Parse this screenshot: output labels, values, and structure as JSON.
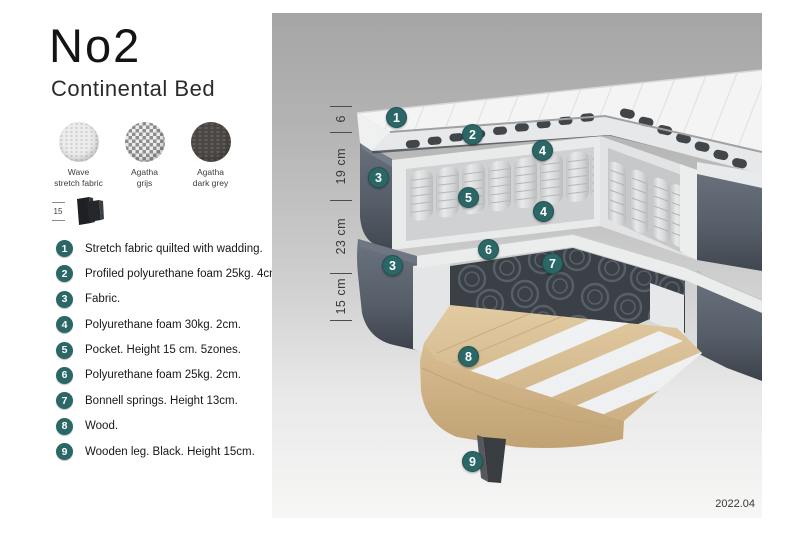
{
  "header": {
    "title": "No2",
    "subtitle": "Continental Bed"
  },
  "swatches": {
    "items": [
      {
        "line1": "Wave",
        "line2": "stretch fabric"
      },
      {
        "line1": "Agatha",
        "line2": "grijs"
      },
      {
        "line1": "Agatha",
        "line2": "dark grey"
      }
    ]
  },
  "leg_spec": {
    "value": "15"
  },
  "legend": {
    "items": [
      {
        "num": "1",
        "text": "Stretch fabric quilted with wadding."
      },
      {
        "num": "2",
        "text": "Profiled polyurethane foam 25kg. 4cm."
      },
      {
        "num": "3",
        "text": "Fabric."
      },
      {
        "num": "4",
        "text": "Polyurethane foam 30kg. 2cm."
      },
      {
        "num": "5",
        "text": "Pocket. Height 15 cm. 5zones."
      },
      {
        "num": "6",
        "text": "Polyurethane foam 25kg. 2cm."
      },
      {
        "num": "7",
        "text": "Bonnell springs. Height 13cm."
      },
      {
        "num": "8",
        "text": "Wood."
      },
      {
        "num": "9",
        "text": "Wooden leg. Black. Height 15cm."
      }
    ]
  },
  "diagram": {
    "measurements": [
      {
        "label": "6"
      },
      {
        "label": "19 cm"
      },
      {
        "label": "23 cm"
      },
      {
        "label": "15 cm"
      }
    ],
    "callouts": [
      {
        "num": "1"
      },
      {
        "num": "2"
      },
      {
        "num": "4"
      },
      {
        "num": "3"
      },
      {
        "num": "5"
      },
      {
        "num": "4"
      },
      {
        "num": "6"
      },
      {
        "num": "7"
      },
      {
        "num": "3"
      },
      {
        "num": "8"
      },
      {
        "num": "9"
      }
    ],
    "version": "2022.04",
    "accent_color": "#2b6767"
  }
}
